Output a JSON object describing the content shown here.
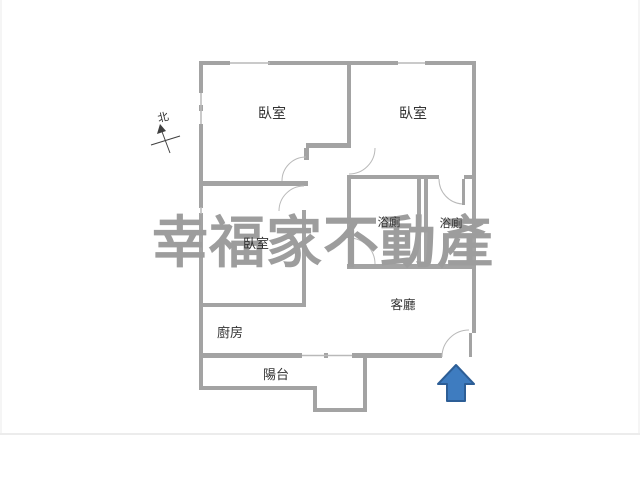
{
  "watermark": {
    "text": "幸福家不動產",
    "color": "#9d9d9d"
  },
  "compass": {
    "label": "北"
  },
  "rooms": {
    "bedroom_top_left": {
      "label": "臥室"
    },
    "bedroom_top_right": {
      "label": "臥室"
    },
    "bedroom_lower_left": {
      "label": "臥室"
    },
    "bathroom_left": {
      "label": "浴廁"
    },
    "bathroom_right": {
      "label": "浴廁"
    },
    "living_room": {
      "label": "客廳"
    },
    "kitchen": {
      "label": "廚房"
    },
    "balcony": {
      "label": "陽台"
    }
  },
  "entrance_arrow": {
    "fill": "#3e7cc0",
    "stroke": "#2d5e96"
  },
  "colors": {
    "wall": "#a3a3a3",
    "window_line": "#b9b9b9",
    "door_arc": "#b9b9b9",
    "label_text": "#333333",
    "frame_line": "#ececec"
  }
}
